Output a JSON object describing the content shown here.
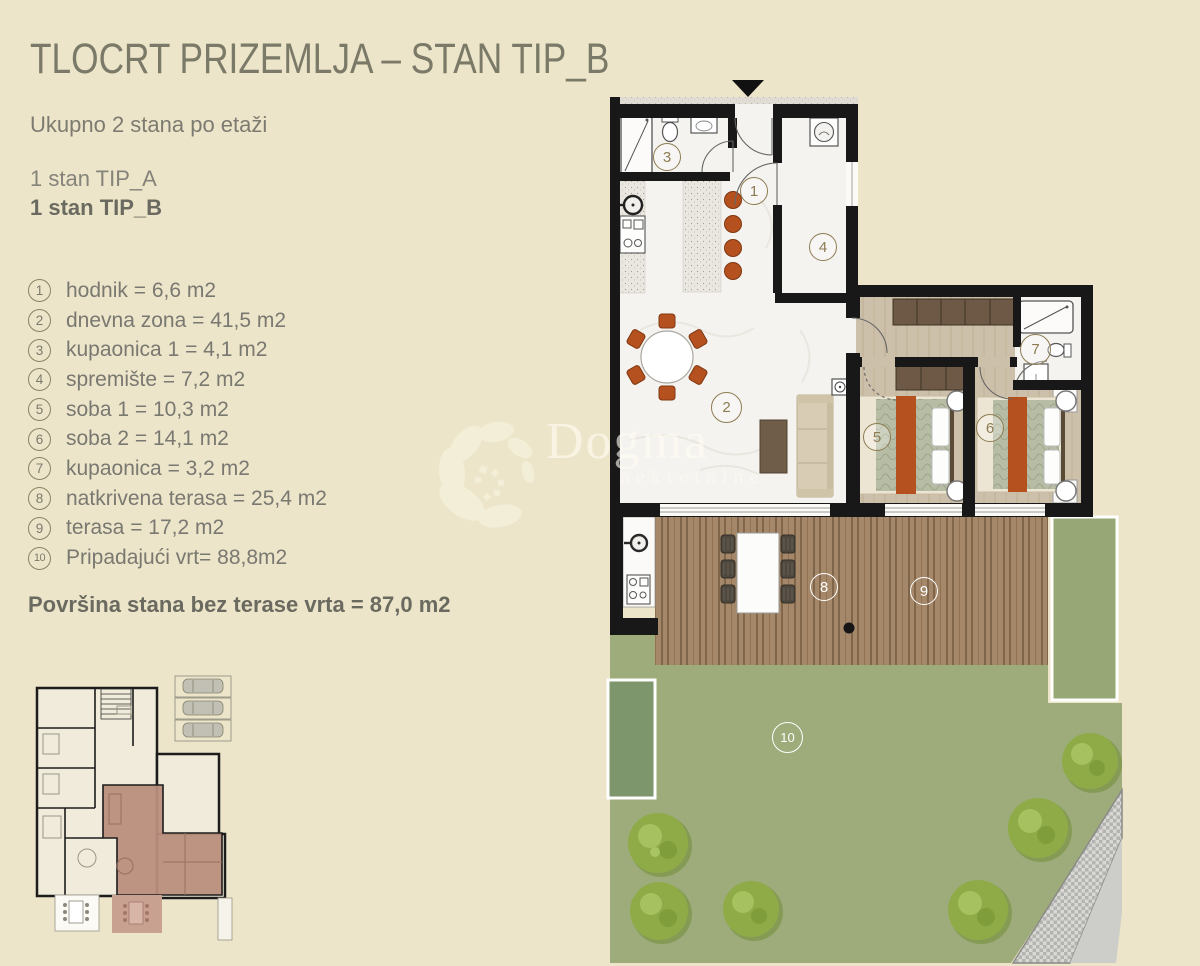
{
  "header": {
    "title": "TLOCRT PRIZEMLJA – STAN TIP_B"
  },
  "info": {
    "units_per_floor": "Ukupno 2 stana po etaži",
    "unit_a": "1 stan TIP_A",
    "unit_b": "1 stan TIP_B"
  },
  "legend": {
    "items": [
      {
        "number": "1",
        "label": "hodnik = 6,6 m2"
      },
      {
        "number": "2",
        "label": "dnevna zona = 41,5 m2"
      },
      {
        "number": "3",
        "label": "kupaonica 1 = 4,1 m2"
      },
      {
        "number": "4",
        "label": "spremište = 7,2 m2"
      },
      {
        "number": "5",
        "label": "soba 1 = 10,3 m2"
      },
      {
        "number": "6",
        "label": "soba 2 = 14,1 m2"
      },
      {
        "number": "7",
        "label": "kupaonica = 3,2 m2"
      },
      {
        "number": "8",
        "label": "natkrivena terasa = 25,4 m2"
      },
      {
        "number": "9",
        "label": "terasa = 17,2 m2"
      },
      {
        "number": "10",
        "label": "Pripadajući vrt= 88,8m2"
      }
    ],
    "summary": "Površina stana bez terase vrta = 87,0 m2"
  },
  "watermark": {
    "brand": "Dogma",
    "subtitle": "nekretnine"
  },
  "colors": {
    "background": "#ece5c9",
    "wall": "#181818",
    "accent_rust": "#b5511f",
    "deck": "#a5886a",
    "grass": "#9dac7a",
    "bush": "#8fab48",
    "label_olive": "#8d7c52",
    "thumbnail_highlight": "#b98e7d"
  }
}
